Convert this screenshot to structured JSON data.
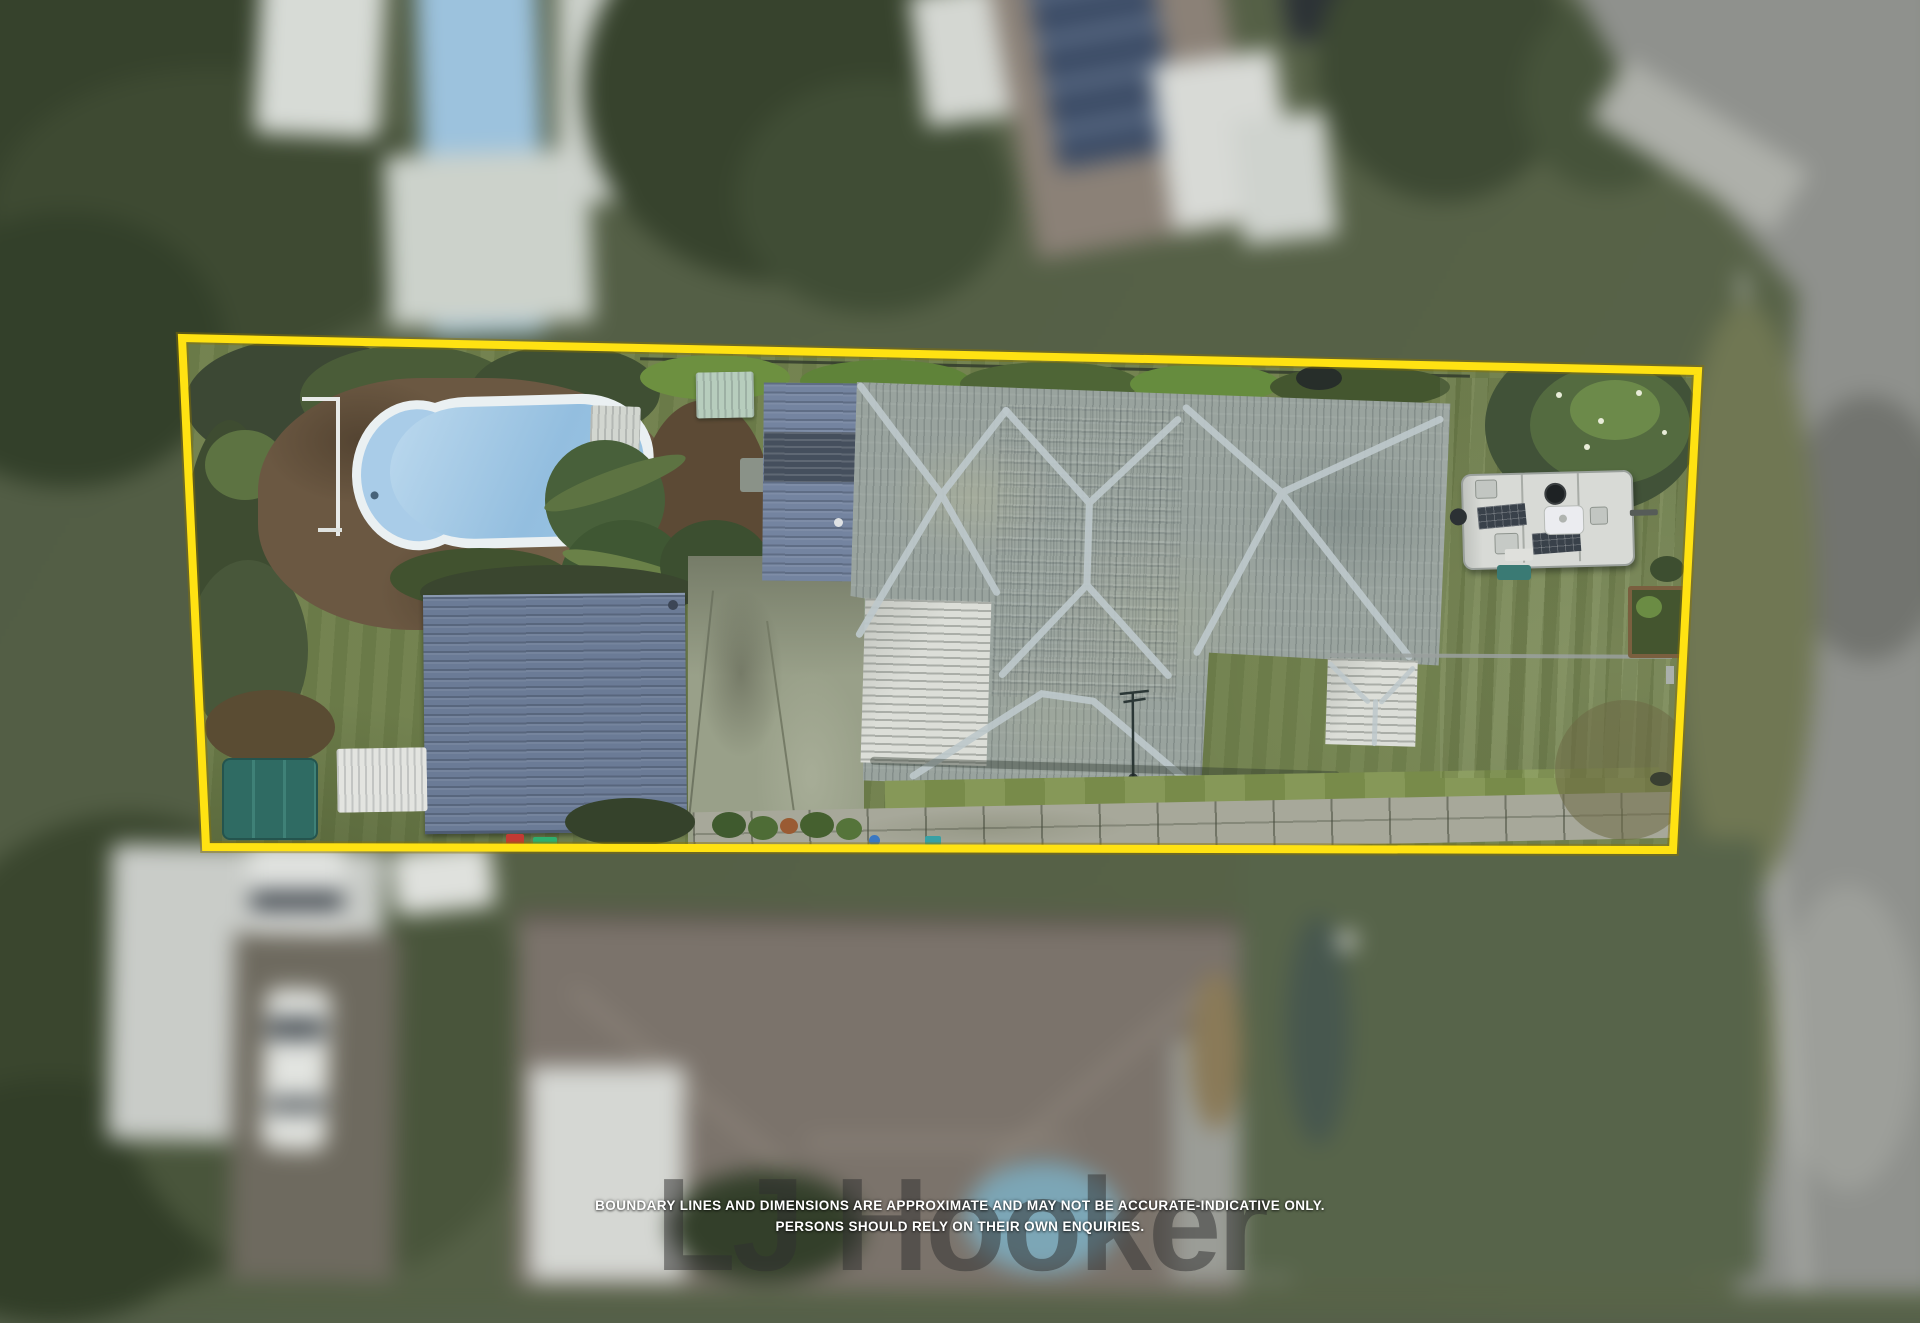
{
  "meta": {
    "type": "aerial-drone-photograph",
    "width_px": 1920,
    "height_px": 1280,
    "description": "Top-down drone photograph of a residential property highlighted with a yellow boundary outline; neighbouring houses, vehicles and the street are blurred."
  },
  "boundary": {
    "label": "property-boundary-outline",
    "points": "182,338 1698,371 1673,850 206,847",
    "color": "#FFE212",
    "stroke_width": "8"
  },
  "disclaimer": {
    "line1": "BOUNDARY LINES AND DIMENSIONS ARE APPROXIMATE AND MAY NOT BE ACCURATE-INDICATIVE ONLY.",
    "line2": "PERSONS SHOULD RELY ON THEIR OWN ENQUIRIES."
  },
  "watermark": {
    "text": "LJ Hooker"
  },
  "colors": {
    "boundary_yellow": "#FFE212",
    "grass_base": "#6f7f4b",
    "grass_bright": "#7e924e",
    "pool_water": "#a9cce8",
    "pool_coping": "#eaf0f2",
    "paving_brown": "#6b5842",
    "shed_roof": "#6b7b96",
    "carport_roof": "#7484a0",
    "carport_dark": "#454f5d",
    "house_roof": "#99a39e",
    "house_ridge": "#bdc8cb",
    "white_roof": "#dcded8",
    "driveway": "#99a089",
    "paver_path": "#a7a89a",
    "caravan_body": "#d8dad6",
    "solar_panel": "#39414a",
    "trampoline_green": "#2f6b63",
    "road_gray": "#8f918d",
    "tree_dark": "#3c4834",
    "disclaimer_white": "#ffffff",
    "watermark_gray": "#303030"
  },
  "scene": {
    "features": [
      "swimming pool with white coping",
      "brown paved pool surround",
      "pool fence post",
      "small green garden shed",
      "small white shed",
      "carport with shade section",
      "main house hip roof (weathered corrugated metal)",
      "white patio roof",
      "white side roof section",
      "tv antenna",
      "large blue-grey shed / garage roof",
      "concrete driveway",
      "paver pathway across back yard",
      "bright mowed lawn strip",
      "caravan with two solar panels, vents and hitch",
      "green trampoline",
      "white canopy",
      "raised garden bed",
      "palm trees and hedges",
      "neighbouring houses, pool, vehicles and street (blurred)"
    ]
  }
}
